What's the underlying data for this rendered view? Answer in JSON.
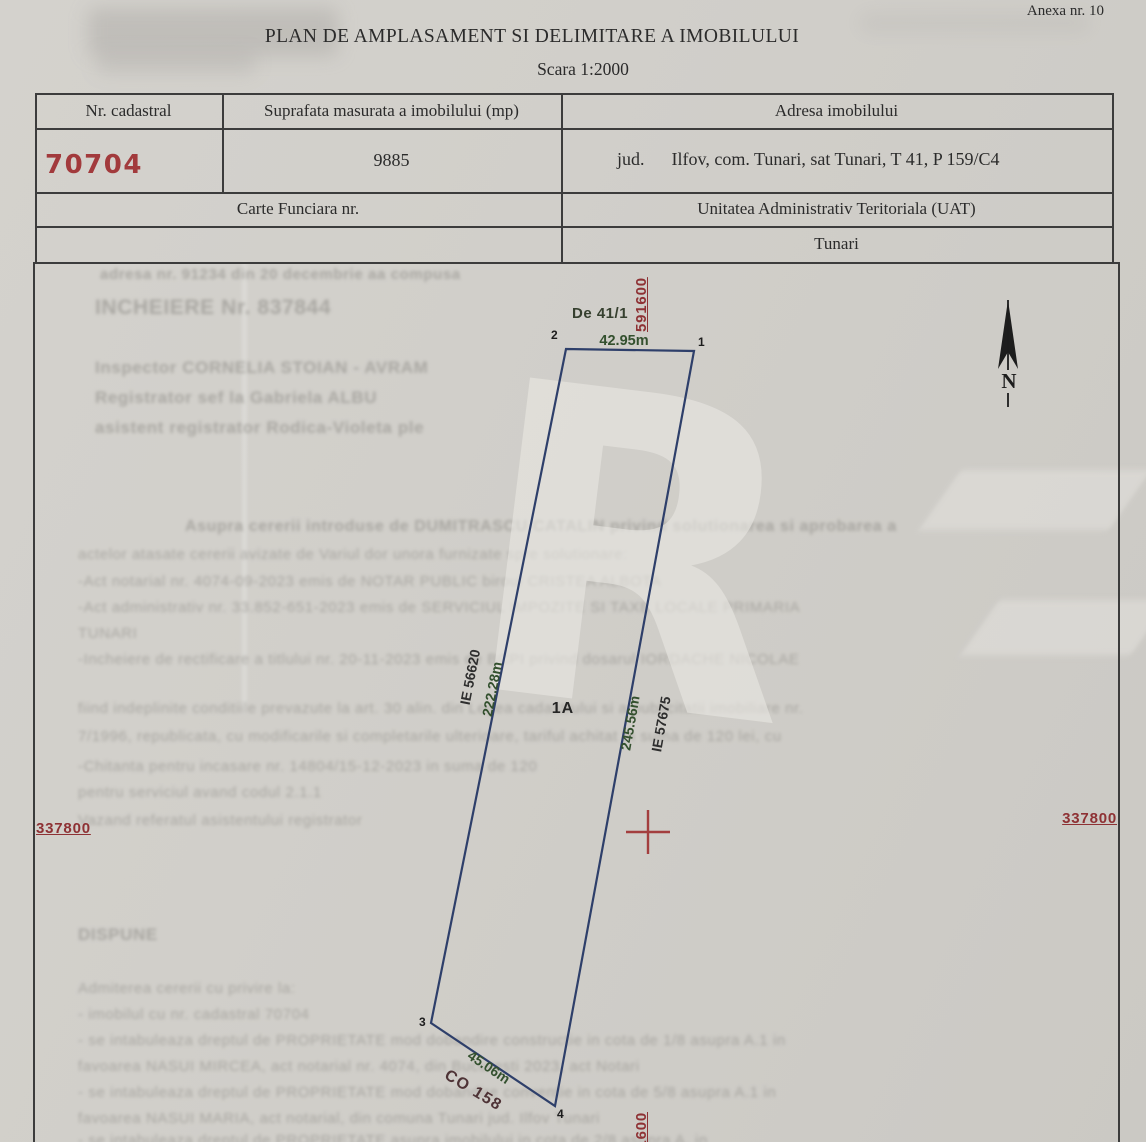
{
  "page": {
    "anexa": "Anexa nr. 10",
    "title": "PLAN DE AMPLASAMENT SI DELIMITARE A IMOBILULUI",
    "subtitle": "Scara 1:2000"
  },
  "table": {
    "col1_header": "Nr. cadastral",
    "col2_header": "Suprafata masurata a imobilului (mp)",
    "col3_header": "Adresa imobilului",
    "cadastral_number": "70704",
    "measured_area": "9885",
    "address_prefix": "jud.",
    "address_value": "Ilfov, com. Tunari, sat Tunari, T 41, P 159/C4",
    "carte_funciara_header": "Carte Funciara nr.",
    "uat_header": "Unitatea Administrativ Teritoriala (UAT)",
    "uat_value": "Tunari"
  },
  "plan": {
    "grid_label_top": "591600",
    "grid_label_bottom": "591600",
    "grid_label_left": "337800",
    "grid_label_right": "337800",
    "road_label": "De 41/1",
    "north_label": "N",
    "parcel_label": "1A",
    "vertex_1": "1",
    "vertex_2": "2",
    "vertex_3": "3",
    "vertex_4": "4",
    "length_top": "42.95m",
    "length_left": "222.28m",
    "length_right": "245.56m",
    "length_bottom": "45.06m",
    "neighbor_left": "IE 56620",
    "neighbor_right": "IE 57675",
    "neighbor_bottom": "CO 158"
  },
  "colors": {
    "stamp_red": "#8e3134",
    "dimension_green": "#33502e",
    "parcel_blue": "#2e3f6a",
    "ink": "#2b2b2b",
    "paper": "#d1cfca"
  },
  "ghost_lines": [
    {
      "t": "adresa nr. 91234 din 20 decembrie aa compusa",
      "x": 100,
      "y": 266,
      "fs": 15,
      "fw": 600
    },
    {
      "t": "INCHEIERE Nr. 837844",
      "x": 95,
      "y": 296,
      "fs": 21,
      "fw": 700
    },
    {
      "t": "Inspector CORNELIA STOIAN - AVRAM",
      "x": 95,
      "y": 358,
      "fs": 17,
      "fw": 600
    },
    {
      "t": "Registrator sef la Gabriela ALBU",
      "x": 95,
      "y": 388,
      "fs": 17,
      "fw": 600
    },
    {
      "t": "asistent registrator Rodica-Violeta ple",
      "x": 95,
      "y": 418,
      "fs": 17,
      "fw": 600
    },
    {
      "t": "Asupra cererii introduse de DUMITRASCU CATALIN privind solutionarea si aprobarea a",
      "x": 185,
      "y": 518,
      "fs": 16,
      "fw": 600
    },
    {
      "t": "actelor atasate cererii avizate de Variul dor unora furnizate spre solutionare:",
      "x": 78,
      "y": 546,
      "fs": 15,
      "fw": 400
    },
    {
      "t": "-Act notarial nr. 4074-09-2023 emis de NOTAR PUBLIC biroul CRISTEA ALBOTA",
      "x": 78,
      "y": 573,
      "fs": 15,
      "fw": 400
    },
    {
      "t": "-Act administrativ nr. 33.852-651-2023 emis de SERVICIUL IMPOZITE SI TAXE LOCALE PRIMARIA",
      "x": 78,
      "y": 599,
      "fs": 15,
      "fw": 400
    },
    {
      "t": "TUNARI",
      "x": 78,
      "y": 625,
      "fs": 15,
      "fw": 400
    },
    {
      "t": "-Incheiere de rectificare a titlului nr. 20-11-2023 emis de BCPI privind dosarul IORDACHE NICOLAE",
      "x": 78,
      "y": 651,
      "fs": 15,
      "fw": 400
    },
    {
      "t": "fiind indeplinite conditiile prevazute la art. 30 alin. din Legea cadastrului si a publicitatii imobiliare nr.",
      "x": 78,
      "y": 700,
      "fs": 15,
      "fw": 400
    },
    {
      "t": "7/1996, republicata, cu modificarile si completarile ulterioare, tariful achitat in suma de 120 lei, cu",
      "x": 78,
      "y": 728,
      "fs": 15,
      "fw": 400
    },
    {
      "t": "-Chitanta pentru incasare nr. 14804/15-12-2023 in suma de 120",
      "x": 78,
      "y": 758,
      "fs": 15,
      "fw": 400
    },
    {
      "t": "pentru serviciul avand codul 2.1.1",
      "x": 78,
      "y": 784,
      "fs": 15,
      "fw": 400
    },
    {
      "t": "Vazand referatul asistentului registrator",
      "x": 78,
      "y": 812,
      "fs": 15,
      "fw": 400
    },
    {
      "t": "DISPUNE",
      "x": 78,
      "y": 925,
      "fs": 17,
      "fw": 700
    },
    {
      "t": "Admiterea cererii cu privire la:",
      "x": 78,
      "y": 980,
      "fs": 15,
      "fw": 400
    },
    {
      "t": "- imobilul cu nr. cadastral 70704",
      "x": 78,
      "y": 1006,
      "fs": 15,
      "fw": 400
    },
    {
      "t": "- se intabuleaza dreptul de PROPRIETATE mod dobandire constructie in cota de 1/8 asupra A.1 in",
      "x": 78,
      "y": 1032,
      "fs": 15,
      "fw": 400
    },
    {
      "t": "favoarea NASUI MIRCEA, act notarial nr. 4074, din Bucuresti 2023, act Notari",
      "x": 78,
      "y": 1058,
      "fs": 15,
      "fw": 400
    },
    {
      "t": "- se intabuleaza dreptul de PROPRIETATE mod dobandire conventie in cota de 5/8 asupra A.1 in",
      "x": 78,
      "y": 1084,
      "fs": 15,
      "fw": 400
    },
    {
      "t": "favoarea NASUI MARIA, act notarial, din comuna Tunari jud. Ilfov Tunari",
      "x": 78,
      "y": 1110,
      "fs": 15,
      "fw": 400
    },
    {
      "t": "- se intabuleaza dreptul de PROPRIETATE asupra imobilului in cota de 2/8 asupra A. in",
      "x": 78,
      "y": 1132,
      "fs": 15,
      "fw": 400
    }
  ]
}
